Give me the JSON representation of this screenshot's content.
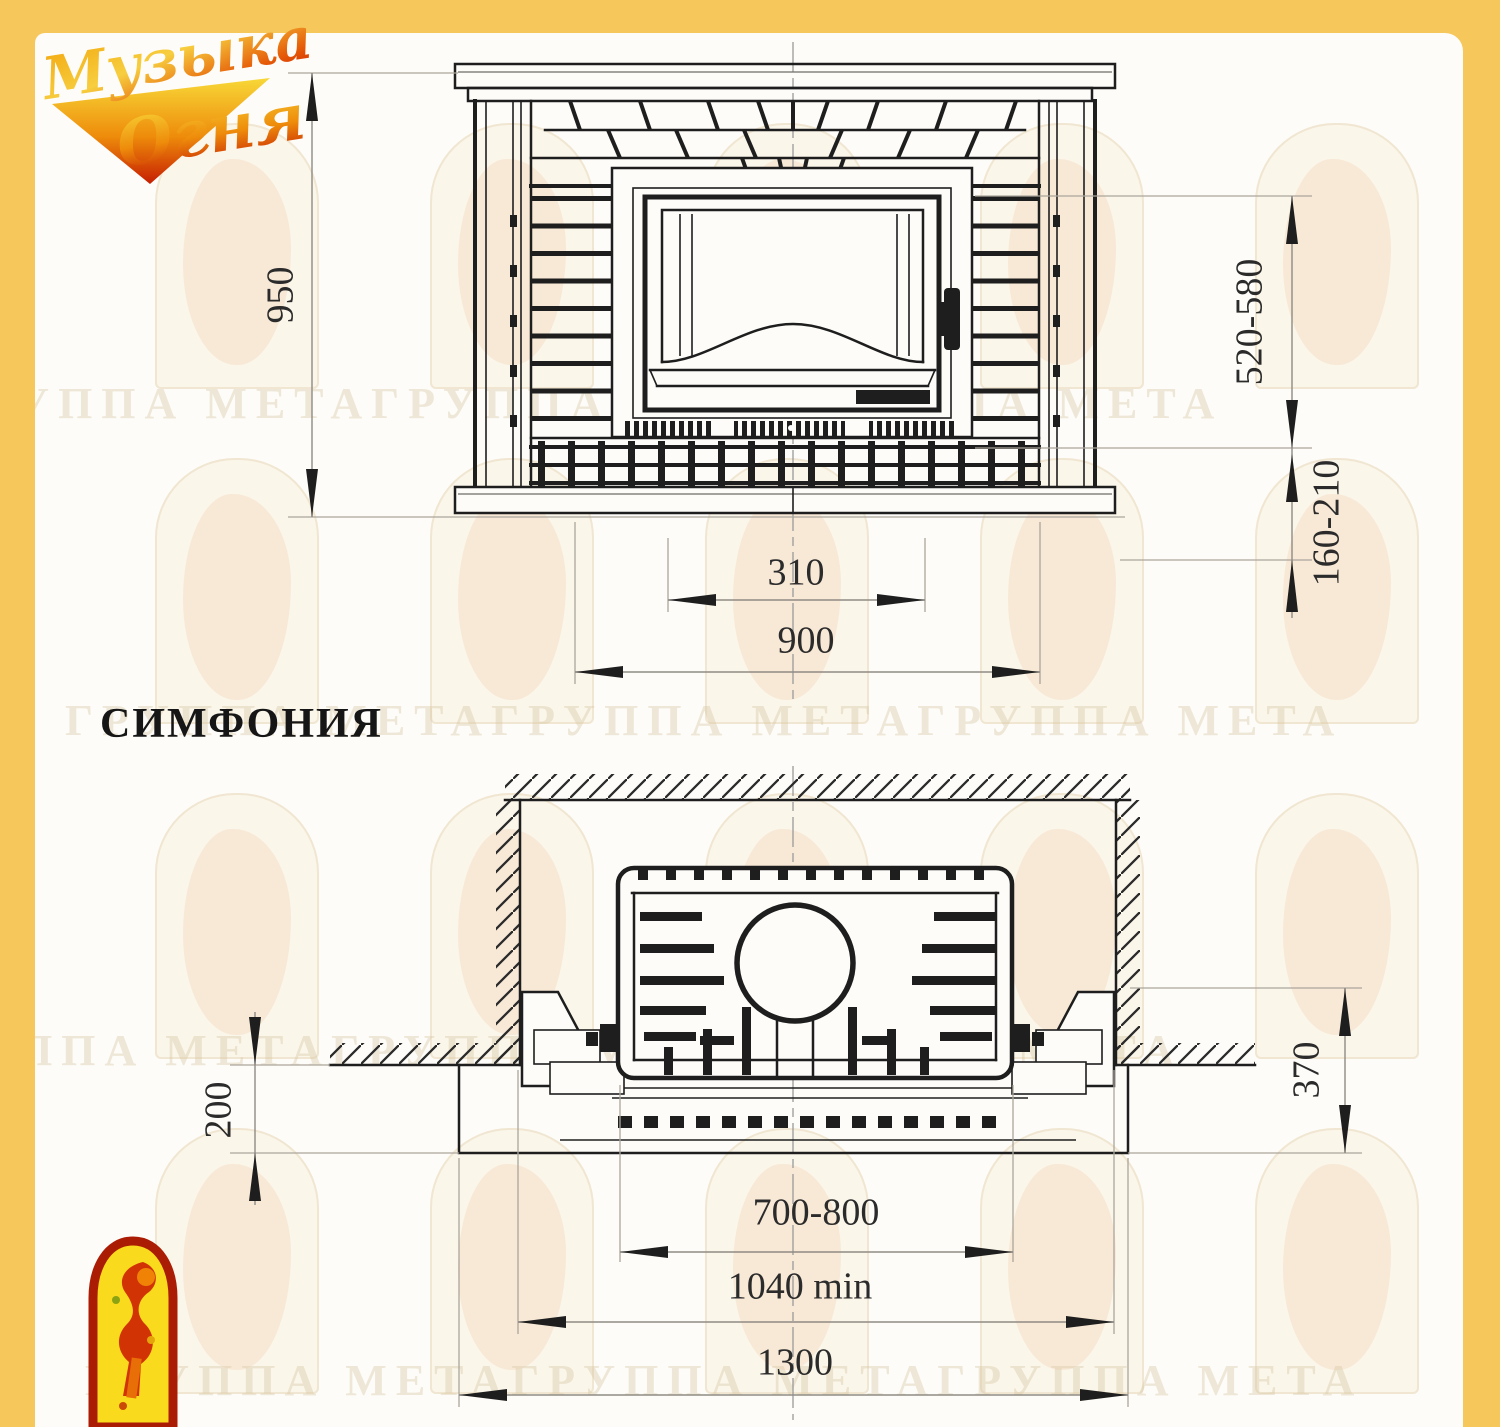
{
  "page": {
    "frame_color": "#F6C75A",
    "sheet_color": "#FDFCF8"
  },
  "brand": {
    "logo_word1": "Музыка",
    "logo_word2": "Огня"
  },
  "watermark": {
    "text": "ГРУППА МЕТАГРУППА МЕТАГРУППА МЕТА"
  },
  "product": {
    "name": "СИМФОНИЯ"
  },
  "front_view": {
    "dim_height": "950",
    "dim_opening_height": "520-580",
    "dim_hearth_height": "160-210",
    "dim_grille_width": "310",
    "dim_body_width": "900"
  },
  "plan_view": {
    "dim_floor_depth": "200",
    "dim_front_offset": "370",
    "dim_insert_width": "700-800",
    "dim_niche_width": "1040 min",
    "dim_base_width": "1300"
  }
}
